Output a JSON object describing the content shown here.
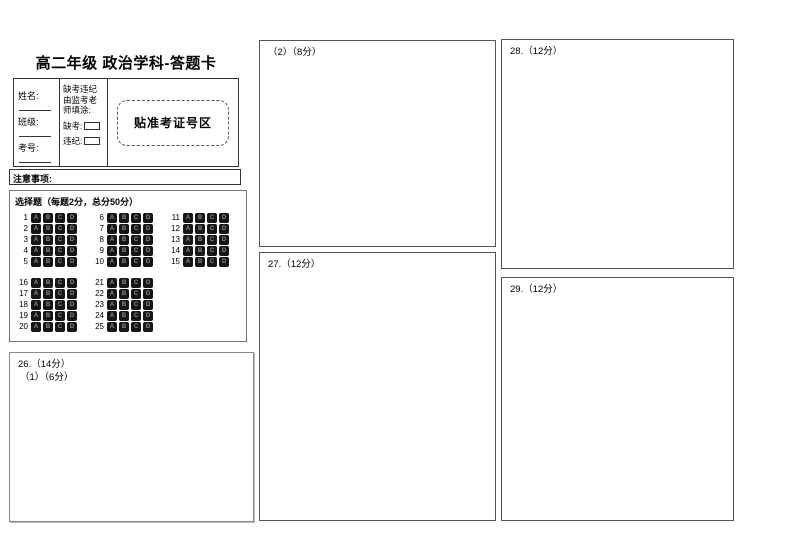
{
  "title": "高二年级 政治学科-答题卡",
  "student_info": {
    "name_label": "姓名:",
    "class_label": "班级:",
    "exam_no_label": "考号:",
    "proctor_note_lines": [
      "缺考违纪",
      "由监考老",
      "师填涂:"
    ],
    "absent_label": "缺考:",
    "violation_label": "违纪:",
    "ticket_paste_label": "贴准考证号区"
  },
  "notes_bar": {
    "label": "注意事项:"
  },
  "choice_section": {
    "header": "选择题（每题2分，总分50分）",
    "options": [
      "A",
      "B",
      "C",
      "D"
    ],
    "blocks": [
      {
        "rows": [
          [
            1,
            6,
            11
          ],
          [
            2,
            7,
            12
          ],
          [
            3,
            8,
            13
          ],
          [
            4,
            9,
            14
          ],
          [
            5,
            10,
            15
          ]
        ]
      },
      {
        "rows": [
          [
            16,
            21
          ],
          [
            17,
            22
          ],
          [
            18,
            23
          ],
          [
            19,
            24
          ],
          [
            20,
            25
          ]
        ]
      }
    ]
  },
  "answer_areas": {
    "q26": {
      "label": "26.（14分）",
      "sublabel": "（1）（6分）"
    },
    "q26_part2": {
      "label": "（2）（8分）"
    },
    "q27": {
      "label": "27.（12分）"
    },
    "q28": {
      "label": "28.（12分）"
    },
    "q29": {
      "label": "29.（12分）"
    }
  }
}
